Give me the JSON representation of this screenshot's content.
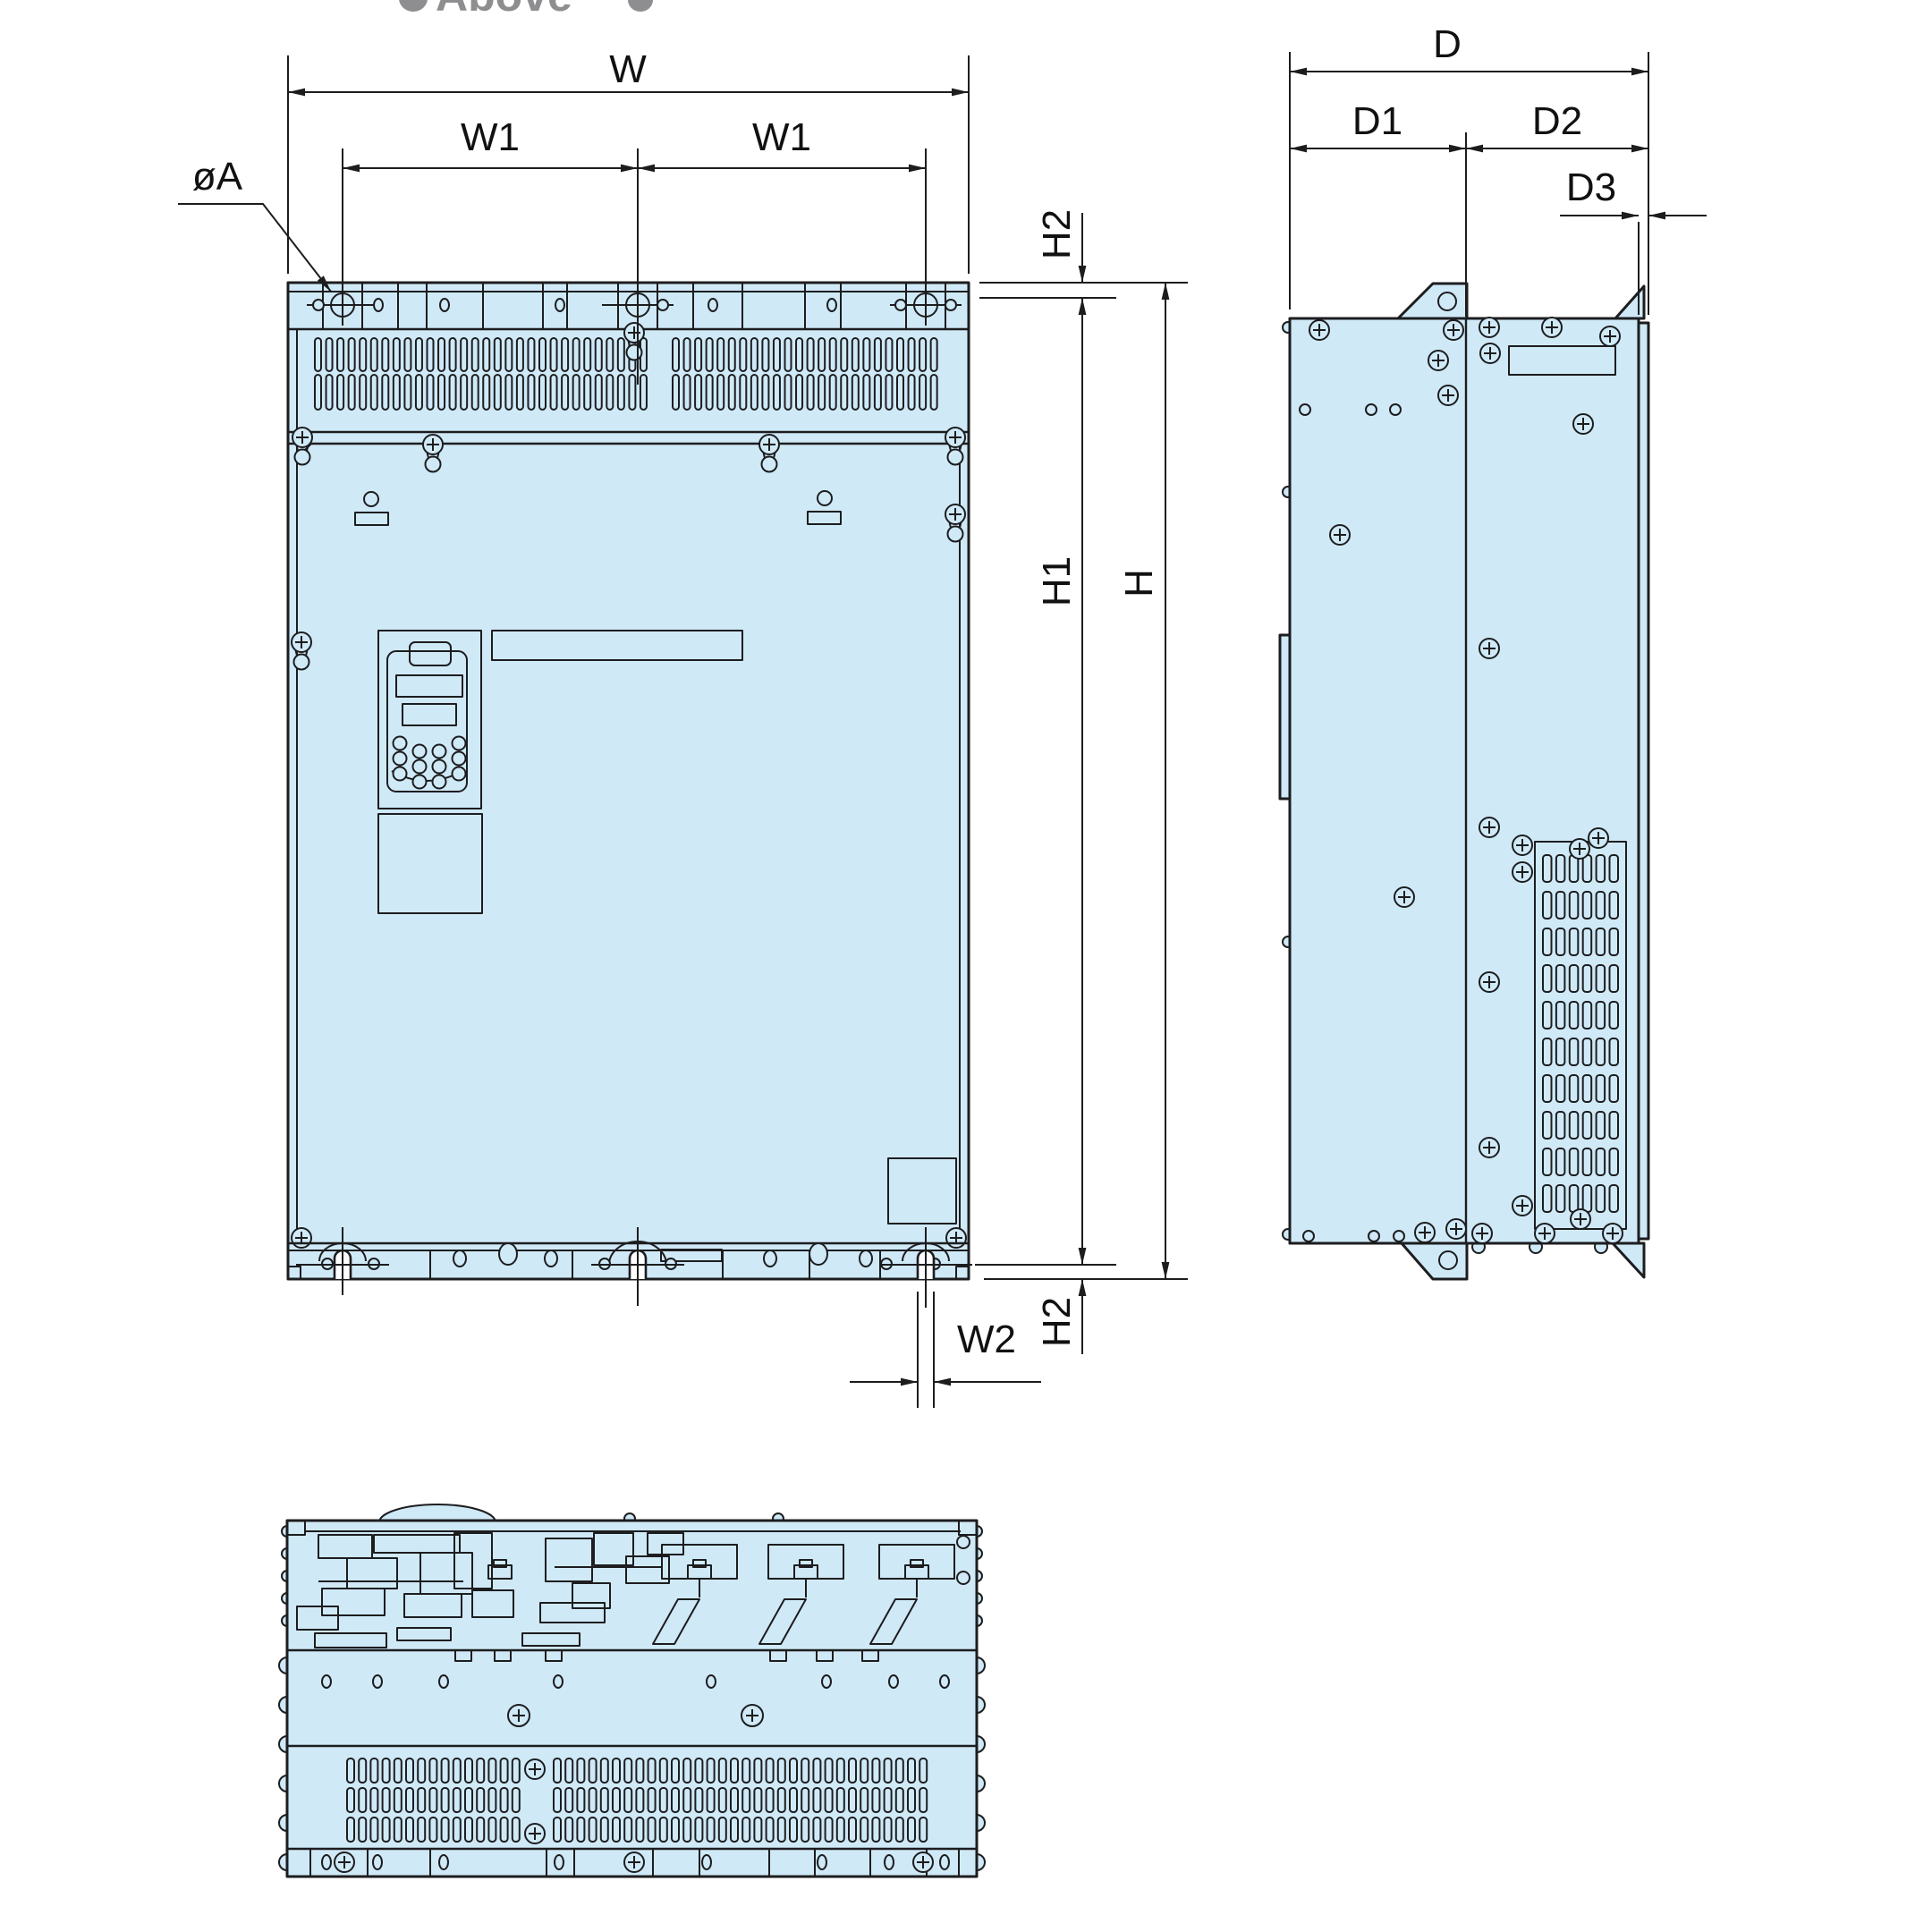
{
  "header": {
    "clipped_text": "Above"
  },
  "colors": {
    "panel_fill": "#cfe9f7",
    "line_color": "#1d1d1f",
    "text_color": "#111111",
    "clipped_text_color": "#8e8e90",
    "background": "#ffffff"
  },
  "dimension_labels": {
    "overall_width": "W",
    "mount_pitch_left": "W1",
    "mount_pitch_right": "W1",
    "bottom_slot_width": "W2",
    "overall_height": "H",
    "mounting_height": "H1",
    "top_edge_to_hole": "H2",
    "bottom_edge_to_hole": "H2",
    "overall_depth": "D",
    "front_depth": "D1",
    "rear_depth": "D2",
    "flange_depth": "D3",
    "mounting_hole_dia": "øA"
  }
}
